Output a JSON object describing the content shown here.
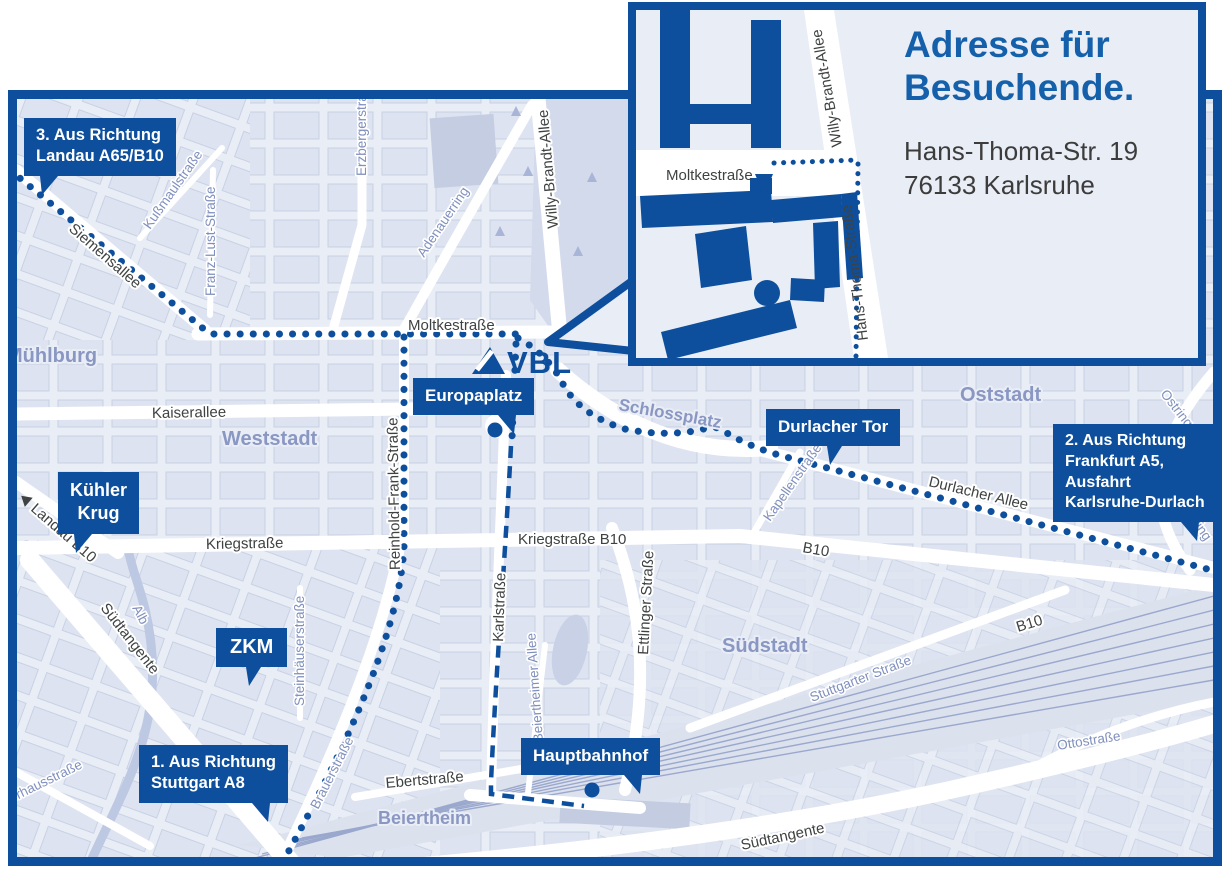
{
  "colors": {
    "brand_blue": "#0d4f9c",
    "title_blue": "#1460ab",
    "map_background": "#e9edf5",
    "block_fill": "#dde3f0",
    "park_fill": "#d3daeb",
    "water": "#bdc8e3",
    "rail": "#9aa8cd",
    "area_label": "#8a97c3",
    "street_label_dark": "#3f4242",
    "street_label_blue": "#8090bd"
  },
  "logo": {
    "text": "VBL"
  },
  "inset": {
    "title_line1": "Adresse für",
    "title_line2": "Besuchende.",
    "address_line1": "Hans-Thoma-Str. 19",
    "address_line2": "76133 Karlsruhe",
    "streets": {
      "moltkestrasse": "Moltkestraße",
      "willy_brandt_allee": "Willy-Brandt-Allee",
      "hans_thoma_strasse": "Hans-Thoma-Straße"
    }
  },
  "callouts": {
    "landau": {
      "line1": "3. Aus Richtung",
      "line2": "Landau A65/B10"
    },
    "kuehler_krug": {
      "line1": "Kühler",
      "line2": "Krug"
    },
    "zkm": {
      "label": "ZKM"
    },
    "stuttgart": {
      "line1": "1. Aus Richtung",
      "line2": "Stuttgart A8"
    },
    "europaplatz": {
      "label": "Europaplatz"
    },
    "hauptbahnhof": {
      "label": "Hauptbahnhof"
    },
    "durlacher_tor": {
      "label": "Durlacher Tor"
    },
    "frankfurt": {
      "line1": "2. Aus Richtung",
      "line2": "Frankfurt A5,",
      "line3": "Ausfahrt",
      "line4": "Karlsruhe-Durlach"
    }
  },
  "streets": {
    "kaiserallee": "Kaiserallee",
    "moltkestrasse": "Moltkestraße",
    "kriegstrasse": "Kriegstraße",
    "kriegstrasse_b10": "Kriegstraße B10",
    "durlacher_allee": "Durlacher Allee",
    "b10_a": "B10",
    "b10_b": "B10",
    "siemensallee": "Siemensallee",
    "kussmaulstrasse": "Kußmaulstraße",
    "franz_lust_strasse": "Franz-Lust-Straße",
    "erzbergerstrasse": "Erzbergerstraße",
    "adenauerring": "Adenauerring",
    "willy_brandt_allee": "Willy-Brandt-Allee",
    "reinhold_frank_strasse": "Reinhold-Frank-Straße",
    "karlstrasse": "Karlstraße",
    "ettlinger_strasse": "Ettlinger Straße",
    "kapellenstrasse": "Kapellenstraße",
    "ostring_a": "Ostring",
    "ostring_b": "Ostring",
    "stuttgarter_strasse": "Stuttgarter Straße",
    "ottostrasse": "Ottostraße",
    "suedtangente_a": "Südtangente",
    "suedtangente_b": "Südtangente",
    "steinhaeuserstrasse": "Steinhäuserstraße",
    "brauerstrasse": "Brauerstraße",
    "ebertstrasse": "Ebertstraße",
    "beiertheimer_allee": "Beiertheimer Allee",
    "pulverhausstrasse": "Pulverhausstraße",
    "landau_b10": "Landau B10",
    "alb": "Alb"
  },
  "areas": {
    "muehlburg": "Mühlburg",
    "weststadt": "Weststadt",
    "oststadt": "Oststadt",
    "suedstadt": "Südstadt",
    "beiertheim": "Beiertheim",
    "schlossplatz": "Schlossplatz"
  }
}
